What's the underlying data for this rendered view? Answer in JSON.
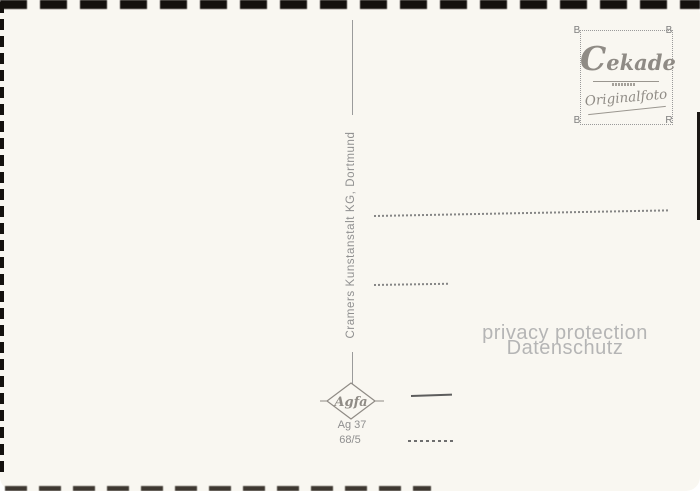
{
  "card": {
    "publisher_line": "Cramers Kunstanstalt KG, Dortmund",
    "stamp_box": {
      "brand": "Cekade",
      "subtitle": "Originalfoto",
      "corners": {
        "top_left": "B",
        "top_right": "B",
        "bottom_left": "B",
        "bottom_right": "R"
      }
    },
    "agfa_logo": {
      "brand": "Agfa"
    },
    "print_code": {
      "line1": "Ag 37",
      "line2": "68/5"
    },
    "watermark": {
      "line1": "privacy protection",
      "line2": "Datenschutz"
    },
    "colors": {
      "card_bg": "#f9f7f1",
      "ink_gray": "#8f8f8f",
      "logo_gray": "#8f8b85",
      "watermark_gray": "#b5b5b5",
      "edge_black": "#14110e"
    }
  }
}
